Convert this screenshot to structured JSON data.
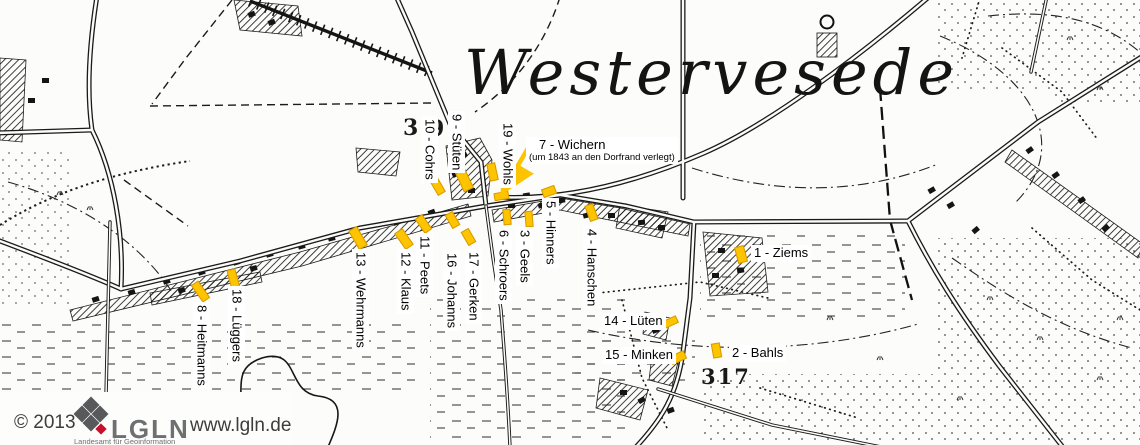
{
  "map": {
    "title": "Westervesede",
    "marker_color": "#FFC400",
    "sheet_numbers": [
      {
        "text": "3",
        "x": 403,
        "y": 117,
        "size": 22
      },
      {
        "text": "9",
        "x": 429,
        "y": 118,
        "size": 22
      },
      {
        "text": "317",
        "x": 701,
        "y": 366,
        "size": 21
      }
    ],
    "arrow": {
      "x1": 531,
      "y1": 143,
      "x2": 506,
      "y2": 186
    },
    "houses": [
      {
        "num": "1",
        "label": "1 - Ziems",
        "dir": "h",
        "marker": {
          "x": 741,
          "y": 254,
          "w": 10,
          "h": 17,
          "rot": -15
        },
        "lx": 751,
        "ly": 245
      },
      {
        "num": "2",
        "label": "2 - Bahls",
        "dir": "h",
        "marker": {
          "x": 716,
          "y": 350,
          "w": 9,
          "h": 15,
          "rot": -10
        },
        "lx": 729,
        "ly": 345
      },
      {
        "num": "3",
        "label": "3 - Geels",
        "dir": "v",
        "marker": {
          "x": 529,
          "y": 219,
          "w": 8,
          "h": 16,
          "rot": -5
        },
        "lx": 516,
        "ly": 227
      },
      {
        "num": "4",
        "label": "4 - Hanschen",
        "dir": "v",
        "marker": {
          "x": 591,
          "y": 212,
          "w": 9,
          "h": 17,
          "rot": -20
        },
        "lx": 583,
        "ly": 226
      },
      {
        "num": "5",
        "label": "5 - Hinners",
        "dir": "v",
        "marker": {
          "x": 549,
          "y": 191,
          "w": 14,
          "h": 9,
          "rot": -20
        },
        "lx": 542,
        "ly": 198
      },
      {
        "num": "6",
        "label": "6 - Schroers",
        "dir": "v",
        "marker": {
          "x": 507,
          "y": 217,
          "w": 8,
          "h": 16,
          "rot": -5
        },
        "lx": 495,
        "ly": 227
      },
      {
        "num": "7",
        "label": "7 - Wichern",
        "sub": "(um 1843 an den Dorfrand verlegt)",
        "dir": "h",
        "marker": {
          "x": 501,
          "y": 196,
          "w": 15,
          "h": 8,
          "rot": -10
        },
        "lx": 526,
        "ly": 137
      },
      {
        "num": "8",
        "label": "8 - Heitmanns",
        "dir": "v",
        "marker": {
          "x": 200,
          "y": 291,
          "w": 9,
          "h": 21,
          "rot": -35
        },
        "lx": 193,
        "ly": 302
      },
      {
        "num": "9",
        "label": "9 - Stüten",
        "dir": "v",
        "marker": {
          "x": 464,
          "y": 180,
          "w": 11,
          "h": 21,
          "rot": -25
        },
        "lx": 448,
        "ly": 111
      },
      {
        "num": "10",
        "label": "10 - Cohrs",
        "dir": "v",
        "marker": {
          "x": 437,
          "y": 186,
          "w": 9,
          "h": 18,
          "rot": -30
        },
        "lx": 421,
        "ly": 116
      },
      {
        "num": "11",
        "label": "11 - Peets",
        "dir": "v",
        "marker": {
          "x": 423,
          "y": 224,
          "w": 9,
          "h": 18,
          "rot": -35
        },
        "lx": 416,
        "ly": 233
      },
      {
        "num": "12",
        "label": "12 - Klaus",
        "dir": "v",
        "marker": {
          "x": 404,
          "y": 239,
          "w": 10,
          "h": 20,
          "rot": -35
        },
        "lx": 397,
        "ly": 249
      },
      {
        "num": "13",
        "label": "13 - Wehrmanns",
        "dir": "v",
        "marker": {
          "x": 358,
          "y": 238,
          "w": 10,
          "h": 22,
          "rot": -30
        },
        "lx": 352,
        "ly": 249
      },
      {
        "num": "14",
        "label": "14 - Lüten",
        "dir": "h",
        "marker": {
          "x": 670,
          "y": 322,
          "w": 15,
          "h": 8,
          "rot": -25
        },
        "lx": 601,
        "ly": 313
      },
      {
        "num": "15",
        "label": "15 - Minken",
        "dir": "h",
        "marker": {
          "x": 678,
          "y": 357,
          "w": 16,
          "h": 9,
          "rot": -25
        },
        "lx": 602,
        "ly": 347
      },
      {
        "num": "16",
        "label": "16 - Johanns",
        "dir": "v",
        "marker": {
          "x": 452,
          "y": 220,
          "w": 9,
          "h": 16,
          "rot": -30
        },
        "lx": 443,
        "ly": 250
      },
      {
        "num": "17",
        "label": "17 - Gerken",
        "dir": "v",
        "marker": {
          "x": 468,
          "y": 237,
          "w": 9,
          "h": 16,
          "rot": -30
        },
        "lx": 465,
        "ly": 249
      },
      {
        "num": "18",
        "label": "18 - Lüggers",
        "dir": "v",
        "marker": {
          "x": 233,
          "y": 279,
          "w": 9,
          "h": 21,
          "rot": -15
        },
        "lx": 228,
        "ly": 286
      },
      {
        "num": "19",
        "label": "19 - Wohls",
        "dir": "v",
        "marker": {
          "x": 492,
          "y": 172,
          "w": 9,
          "h": 18,
          "rot": -12
        },
        "lx": 499,
        "ly": 120
      }
    ]
  },
  "footer": {
    "copyright": "© 2013",
    "org": "LGLN",
    "org_subtitle": "Landesamt für Geoinformation",
    "url": "www.lgln.de"
  }
}
